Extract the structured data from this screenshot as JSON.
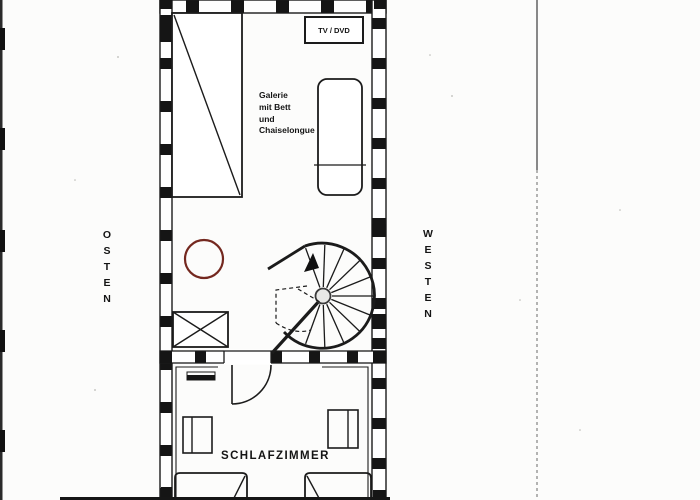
{
  "labels": {
    "orientation_left": "OSTEN",
    "orientation_right": "WESTEN",
    "tv_unit": "TV / DVD",
    "gallery_lines": [
      "Galerie",
      "mit Bett",
      "und",
      "Chaiselongue"
    ],
    "bedroom": "SCHLAFZIMMER"
  },
  "colors": {
    "ink": "#1b1b1b",
    "table_circle": "#74281f",
    "paper": "#fcfcfb"
  }
}
